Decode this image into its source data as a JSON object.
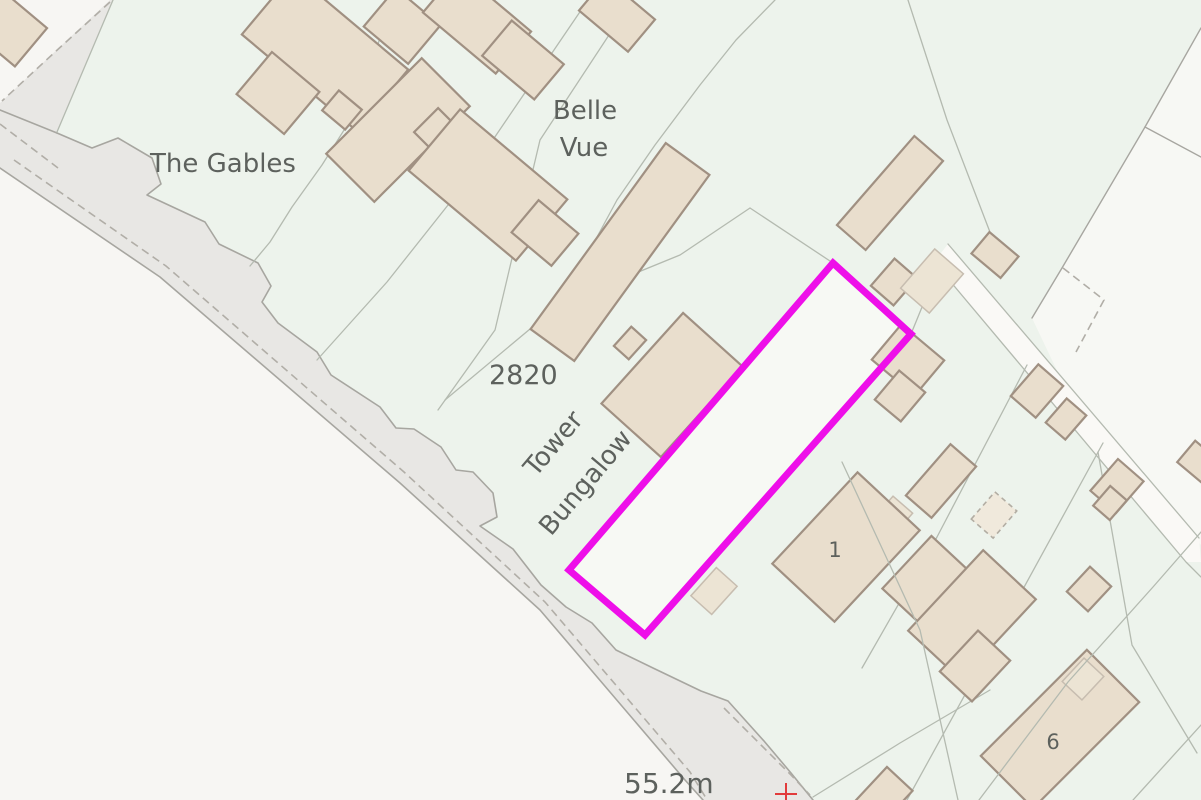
{
  "map": {
    "type": "ordnance-survey-style site plan",
    "canvas": {
      "width": 1201,
      "height": 800
    },
    "colors": {
      "parcel_green": "#edf3ec",
      "offland_white": "#f7f6f3",
      "ne_white": "#f7f8f4",
      "highway_verge_gray": "#e8e7e4",
      "track_white": "#faf9f6",
      "plot_fill": "#f7f9f4",
      "building_fill": "#e9decd",
      "building_stroke": "#a09082",
      "shed_fill": "#ece4d4",
      "shed_stroke": "#c7bdb0",
      "dashed_shed_fill": "#f0e9dc",
      "dashed_shed_stroke": "#b2ada3",
      "parcel_line": "#b4bab0",
      "road_edge": "#a7a6a0",
      "dash_line": "#b1aea7",
      "plot_outline": "#ee0fe9",
      "text": "#5d615d",
      "cross_red": "#e23b3b"
    },
    "area_polygons": [
      {
        "name": "base-parcels",
        "points": "0,0 1201,0 1201,800 0,800",
        "fill": "parcel_green"
      },
      {
        "name": "land-southwest-of-road",
        "points": "113,0 57,133 92,148 118,138 152,158 161,184 147,195 205,222 219,244 258,263 271,286 262,302 278,323 317,352 331,375 380,407 396,428 414,429 441,447 456,470 473,472 493,493 497,517 480,526 513,549 541,585 566,607 592,623 616,650 653,668 701,691 728,701 764,741 791,773 813,800 0,800 0,0",
        "fill": "offland_white"
      },
      {
        "name": "land-northeast-corner",
        "points": "1201,28 1145,127 1062,268 1032,318 1071,400 1201,545",
        "fill": "ne_white"
      },
      {
        "name": "track-surface",
        "points": "948,244 1199,538 1201,562 1186,562 934,262",
        "fill": "track_white"
      },
      {
        "name": "highway-verge",
        "points": "110,0 113,0 57,133 92,148 118,138 152,158 161,184 147,195 205,222 219,244 258,263 271,286 262,302 278,323 317,352 331,375 380,407 396,428 414,429 441,447 456,470 473,472 493,493 497,517 480,526 513,549 541,585 566,607 592,623 616,650 653,668 701,691 728,701 764,741 791,773 813,800 703,800 685,780 540,610 400,483 160,277 0,168 0,103",
        "fill": "highway_verge_gray"
      },
      {
        "name": "plot-parcel",
        "points": "833,263 911,334 645,635 569,570",
        "fill": "plot_fill"
      }
    ],
    "solid_lines": [
      {
        "name": "frontage-edge",
        "points": "57,133 92,148 118,138 152,158 161,184 147,195 205,222 219,244 258,263 271,286 262,302 278,323 317,352 331,375 380,407 396,428 414,429 441,447 456,470 473,472 493,493 497,517 480,526 513,549 541,585 566,607 592,623 616,650 653,668 701,691 728,701 764,741 791,773 813,800",
        "color": "road_edge",
        "width": 1.6
      },
      {
        "name": "frontage-stub",
        "points": "0,110 57,133",
        "color": "road_edge",
        "width": 1.6
      },
      {
        "name": "carriageway-edge",
        "points": "0,168 160,277 400,483 540,610 685,780 703,800",
        "color": "road_edge",
        "width": 1.6
      },
      {
        "name": "parcel-line-west",
        "points": "113,0 57,132",
        "color": "parcel_line",
        "width": 1.3
      },
      {
        "name": "parcel-line-gables-east",
        "points": "390,0 363,100 322,165 292,207 270,242 250,266",
        "color": "parcel_line",
        "width": 1.3
      },
      {
        "name": "parcel-line-bellevue-west",
        "points": "588,0 520,100 452,200 387,282 317,360",
        "color": "parcel_line",
        "width": 1.3
      },
      {
        "name": "parcel-line-bellevue-east",
        "points": "632,0 540,140 495,330 438,410",
        "color": "parcel_line",
        "width": 1.3
      },
      {
        "name": "parcel-line-mid",
        "points": "775,0 736,40 700,85 655,145 617,200 590,250 563,302",
        "color": "parcel_line",
        "width": 1.3
      },
      {
        "name": "parcel-line-plot-northwest",
        "points": "750,208 680,255 560,304 445,400",
        "color": "parcel_line",
        "width": 1.3
      },
      {
        "name": "parcel-line-plot-apex",
        "points": "750,208 833,263",
        "color": "parcel_line",
        "width": 1.3
      },
      {
        "name": "parcel-line-plot-east-spur",
        "points": "911,334 938,268",
        "color": "parcel_line",
        "width": 1.3
      },
      {
        "name": "parcel-line-northeast",
        "points": "908,0 947,120 993,240",
        "color": "parcel_line",
        "width": 1.3
      },
      {
        "name": "boundary-ne-white",
        "points": "1201,28 1145,127 1062,268 1032,318",
        "color": "road_edge",
        "width": 1.4
      },
      {
        "name": "boundary-ne-branch",
        "points": "1145,127 1201,157",
        "color": "road_edge",
        "width": 1.4
      },
      {
        "name": "track-edge-a",
        "points": "948,244 1199,538",
        "color": "parcel_line",
        "width": 1.3
      },
      {
        "name": "track-edge-b",
        "points": "934,262 1186,562 1201,577",
        "color": "parcel_line",
        "width": 1.3
      },
      {
        "name": "parcel-line-right-1",
        "points": "1027,365 937,537 862,668",
        "color": "parcel_line",
        "width": 1.3
      },
      {
        "name": "parcel-line-right-2",
        "points": "1103,443 1005,622 907,800",
        "color": "parcel_line",
        "width": 1.3
      },
      {
        "name": "parcel-line-right-3",
        "points": "1098,452 1132,645 1197,753",
        "color": "parcel_line",
        "width": 1.3
      },
      {
        "name": "parcel-line-bottom-corner",
        "points": "1201,725 1133,800",
        "color": "parcel_line",
        "width": 1.3
      },
      {
        "name": "parcel-line-bottom-road",
        "points": "813,797 900,743 990,690",
        "color": "parcel_line",
        "width": 1.3
      }
    ],
    "overlay_lines": [
      {
        "name": "parcel-line-through-house1",
        "points": "842,462 920,630 958,800",
        "color": "parcel_line",
        "width": 1.3
      },
      {
        "name": "parcel-line-through-house6",
        "points": "1201,532 1153,587 1068,682 979,800",
        "color": "parcel_line",
        "width": 1.3
      }
    ],
    "dashed_lines": [
      {
        "name": "lane-edge-dashed",
        "points": "110,2 55,52 2,101"
      },
      {
        "name": "verge-inner-dash-top",
        "points": "0,124 58,168"
      },
      {
        "name": "carriageway-dash",
        "points": "14,160 166,266 404,472 545,602 690,772 706,798"
      },
      {
        "name": "verge-dash-bottom",
        "points": "724,708 762,746 790,774 810,795"
      },
      {
        "name": "dashed-parcel-corner",
        "points": "1063,268 1104,300 1076,352"
      }
    ],
    "buildings": [
      {
        "name": "building-corner-nw",
        "cx": 8,
        "cy": 28,
        "w": 60,
        "h": 50,
        "rot": 40,
        "style": "house"
      },
      {
        "name": "building-gables-main",
        "cx": 325,
        "cy": 52,
        "w": 150,
        "h": 80,
        "rot": 40,
        "style": "house"
      },
      {
        "name": "building-gables-wing",
        "cx": 278,
        "cy": 93,
        "w": 62,
        "h": 55,
        "rot": 40,
        "style": "house"
      },
      {
        "name": "building-gables-outbuilding",
        "cx": 342,
        "cy": 110,
        "w": 30,
        "h": 26,
        "rot": 40,
        "style": "house"
      },
      {
        "name": "building-top-1",
        "cx": 402,
        "cy": 26,
        "w": 58,
        "h": 50,
        "rot": 40,
        "style": "house"
      },
      {
        "name": "building-top-2",
        "cx": 468,
        "cy": 16,
        "w": 72,
        "h": 44,
        "rot": 40,
        "style": "house"
      },
      {
        "name": "building-stepped-main",
        "cx": 398,
        "cy": 130,
        "w": 135,
        "h": 68,
        "rot": -45,
        "style": "house"
      },
      {
        "name": "building-stepped-step",
        "cx": 436,
        "cy": 130,
        "w": 34,
        "h": 28,
        "rot": -45,
        "style": "house"
      },
      {
        "name": "building-top-3-main",
        "cx": 477,
        "cy": 22,
        "w": 95,
        "h": 55,
        "rot": 40,
        "style": "house"
      },
      {
        "name": "building-top-3-wing",
        "cx": 523,
        "cy": 60,
        "w": 68,
        "h": 46,
        "rot": 40,
        "style": "house"
      },
      {
        "name": "building-top-4",
        "cx": 617,
        "cy": 15,
        "w": 64,
        "h": 42,
        "rot": 40,
        "style": "house"
      },
      {
        "name": "building-bellevue-main",
        "cx": 488,
        "cy": 185,
        "w": 140,
        "h": 80,
        "rot": 40,
        "style": "house"
      },
      {
        "name": "building-bellevue-wing",
        "cx": 545,
        "cy": 233,
        "w": 52,
        "h": 42,
        "rot": 40,
        "style": "house"
      },
      {
        "name": "building-long-north-of-plot",
        "cx": 620,
        "cy": 252,
        "w": 230,
        "h": 54,
        "rot": -54,
        "style": "house"
      },
      {
        "name": "building-thin-northeast",
        "cx": 890,
        "cy": 193,
        "w": 118,
        "h": 38,
        "rot": -49,
        "style": "house"
      },
      {
        "name": "building-small-sq-ne",
        "cx": 894,
        "cy": 282,
        "w": 36,
        "h": 30,
        "rot": -49,
        "style": "house"
      },
      {
        "name": "building-small-ne-2",
        "cx": 995,
        "cy": 255,
        "w": 38,
        "h": 28,
        "rot": 40,
        "style": "house"
      },
      {
        "name": "shed-ne",
        "cx": 932,
        "cy": 281,
        "w": 52,
        "h": 38,
        "rot": -49,
        "style": "shed"
      },
      {
        "name": "building-east-of-plot-main",
        "cx": 908,
        "cy": 360,
        "w": 56,
        "h": 46,
        "rot": 40,
        "style": "house"
      },
      {
        "name": "building-east-of-plot-annex",
        "cx": 900,
        "cy": 396,
        "w": 34,
        "h": 38,
        "rot": 40,
        "style": "house"
      },
      {
        "name": "building-tower-bungalow",
        "cx": 672,
        "cy": 385,
        "w": 122,
        "h": 80,
        "rot": -48,
        "style": "house"
      },
      {
        "name": "building-tower-bungalow-step",
        "cx": 630,
        "cy": 343,
        "w": 26,
        "h": 20,
        "rot": -48,
        "style": "house"
      },
      {
        "name": "shed-in-plot-south",
        "cx": 714,
        "cy": 591,
        "w": 38,
        "h": 28,
        "rot": -48,
        "style": "shed"
      },
      {
        "name": "building-sq-right-1",
        "cx": 1037,
        "cy": 391,
        "w": 42,
        "h": 33,
        "rot": -49,
        "style": "house"
      },
      {
        "name": "building-sq-right-2",
        "cx": 1066,
        "cy": 419,
        "w": 32,
        "h": 26,
        "rot": -49,
        "style": "house"
      },
      {
        "name": "building-l-right-main",
        "cx": 1117,
        "cy": 486,
        "w": 42,
        "h": 34,
        "rot": -49,
        "style": "house"
      },
      {
        "name": "building-l-right-annex",
        "cx": 1110,
        "cy": 503,
        "w": 26,
        "h": 22,
        "rot": -49,
        "style": "house"
      },
      {
        "name": "building-long-right",
        "cx": 941,
        "cy": 481,
        "w": 68,
        "h": 34,
        "rot": -49,
        "style": "house"
      },
      {
        "name": "outbuilding-dashed",
        "cx": 994,
        "cy": 515,
        "w": 36,
        "h": 29,
        "rot": -49,
        "style": "dashed"
      },
      {
        "name": "shed-near-house1",
        "cx": 893,
        "cy": 516,
        "w": 30,
        "h": 26,
        "rot": -49,
        "style": "shed"
      },
      {
        "name": "house-1-main",
        "cx": 846,
        "cy": 547,
        "w": 125,
        "h": 85,
        "rot": -47,
        "style": "house"
      },
      {
        "name": "house-1-annex",
        "cx": 927,
        "cy": 581,
        "w": 72,
        "h": 55,
        "rot": -47,
        "style": "house"
      },
      {
        "name": "house-mid-main",
        "cx": 972,
        "cy": 615,
        "w": 110,
        "h": 72,
        "rot": -47,
        "style": "house"
      },
      {
        "name": "house-mid-annex",
        "cx": 975,
        "cy": 666,
        "w": 56,
        "h": 44,
        "rot": -47,
        "style": "house"
      },
      {
        "name": "house-6-main",
        "cx": 1060,
        "cy": 729,
        "w": 150,
        "h": 74,
        "rot": -45,
        "style": "house"
      },
      {
        "name": "building-sq-right-3",
        "cx": 1089,
        "cy": 589,
        "w": 34,
        "h": 29,
        "rot": -47,
        "style": "house"
      },
      {
        "name": "shed-right-low",
        "cx": 1083,
        "cy": 679,
        "w": 32,
        "h": 27,
        "rot": -47,
        "style": "shed"
      },
      {
        "name": "building-bottom-edge",
        "cx": 881,
        "cy": 799,
        "w": 55,
        "h": 35,
        "rot": -47,
        "style": "house"
      },
      {
        "name": "building-right-edge",
        "cx": 1200,
        "cy": 463,
        "w": 36,
        "h": 28,
        "rot": 40,
        "style": "house"
      }
    ],
    "plot_outline": {
      "points": "833,263 911,334 645,635 569,570",
      "stroke_width": 7
    },
    "benchmark_cross": {
      "x": 786,
      "y": 794,
      "arm": 11
    },
    "labels": [
      {
        "id": "label-the-gables",
        "text": "The Gables",
        "x": 150,
        "y": 172,
        "size": 26,
        "anchor": "start",
        "rot": 0
      },
      {
        "id": "label-belle",
        "text": "Belle",
        "x": 585,
        "y": 119,
        "size": 26,
        "anchor": "middle",
        "rot": 0
      },
      {
        "id": "label-vue",
        "text": "Vue",
        "x": 584,
        "y": 156,
        "size": 26,
        "anchor": "middle",
        "rot": 0
      },
      {
        "id": "label-2820",
        "text": "2820",
        "x": 489,
        "y": 384,
        "size": 27,
        "anchor": "start",
        "rot": 0
      },
      {
        "id": "label-tower",
        "text": "Tower",
        "x": 560,
        "y": 449,
        "size": 26,
        "anchor": "middle",
        "rot": -50
      },
      {
        "id": "label-bungalow",
        "text": "Bungalow",
        "x": 592,
        "y": 488,
        "size": 26,
        "anchor": "middle",
        "rot": -50
      },
      {
        "id": "label-spot-height",
        "text": "55.2m",
        "x": 624,
        "y": 793,
        "size": 28,
        "anchor": "start",
        "rot": 0
      },
      {
        "id": "label-house-1",
        "text": "1",
        "x": 835,
        "y": 557,
        "size": 21,
        "anchor": "middle",
        "rot": 0
      },
      {
        "id": "label-house-6",
        "text": "6",
        "x": 1053,
        "y": 749,
        "size": 21,
        "anchor": "middle",
        "rot": 0
      }
    ]
  }
}
